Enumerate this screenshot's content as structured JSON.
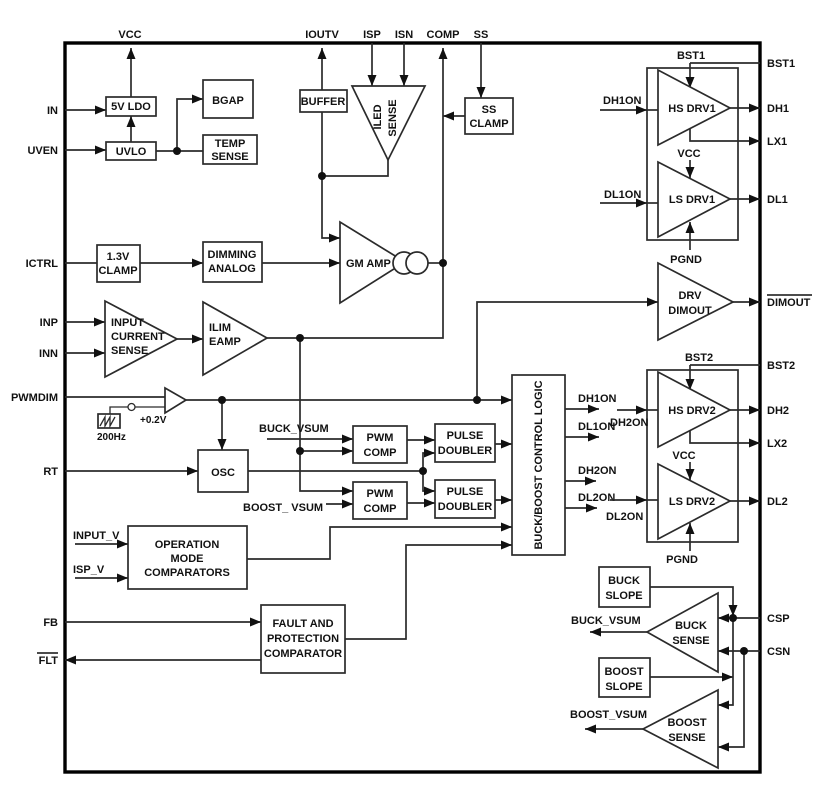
{
  "pins": {
    "top": [
      "VCC",
      "IOUTV",
      "ISP",
      "ISN",
      "COMP",
      "SS"
    ],
    "left": [
      "IN",
      "UVEN",
      "ICTRL",
      "INP",
      "INN",
      "PWMDIM",
      "RT",
      "FB",
      "FLT"
    ],
    "right": [
      "BST1",
      "DH1",
      "LX1",
      "DL1",
      "DIMOUT",
      "BST2",
      "DH2",
      "LX2",
      "DL2",
      "CSP",
      "CSN"
    ]
  },
  "blocks": {
    "ldo": "5V LDO",
    "uvlo": "UVLO",
    "bgap": "BGAP",
    "temp_sense": [
      "TEMP",
      "SENSE"
    ],
    "buffer": "BUFFER",
    "iled_sense": [
      "ILED",
      "SENSE"
    ],
    "ss_clamp": [
      "SS",
      "CLAMP"
    ],
    "clamp13": [
      "1.3V",
      "CLAMP"
    ],
    "dimming": [
      "DIMMING",
      "ANALOG"
    ],
    "gm_amp": "GM AMP",
    "input_sense": [
      "INPUT",
      "CURRENT",
      "SENSE"
    ],
    "ilim": [
      "ILIM",
      "EAMP"
    ],
    "drv_dimout": [
      "DRV",
      "DIMOUT"
    ],
    "osc": "OSC",
    "pwm_comp": [
      "PWM",
      "COMP"
    ],
    "pulse_doubler": [
      "PULSE",
      "DOUBLER"
    ],
    "control_logic": "BUCK/BOOST CONTROL LOGIC",
    "op_mode": [
      "OPERATION",
      "MODE",
      "COMPARATORS"
    ],
    "fault": [
      "FAULT AND",
      "PROTECTION",
      "COMPARATOR"
    ],
    "buck_slope": [
      "BUCK",
      "SLOPE"
    ],
    "boost_slope": [
      "BOOST",
      "SLOPE"
    ],
    "buck_sense": [
      "BUCK",
      "SENSE"
    ],
    "boost_sense": [
      "BOOST",
      "SENSE"
    ],
    "hs_drv1": "HS DRV1",
    "ls_drv1": "LS DRV1",
    "hs_drv2": "HS DRV2",
    "ls_drv2": "LS DRV2"
  },
  "signals": {
    "bst1": "BST1",
    "bst2": "BST2",
    "vcc": "VCC",
    "pgnd": "PGND",
    "dh1on": "DH1ON",
    "dl1on": "DL1ON",
    "dh2on": "DH2ON",
    "dl2on": "DL2ON",
    "buck_vsum": "BUCK_VSUM",
    "boost_vsum_in": "BOOST_ VSUM",
    "boost_vsum": "BOOST_VSUM",
    "input_v": "INPUT_V",
    "isp_v": "ISP_V",
    "sawtooth_freq": "200Hz",
    "sawtooth_offset": "+0.2V"
  },
  "colors": {
    "line": "#2b2b2b",
    "text": "#111111",
    "background": "#ffffff"
  }
}
